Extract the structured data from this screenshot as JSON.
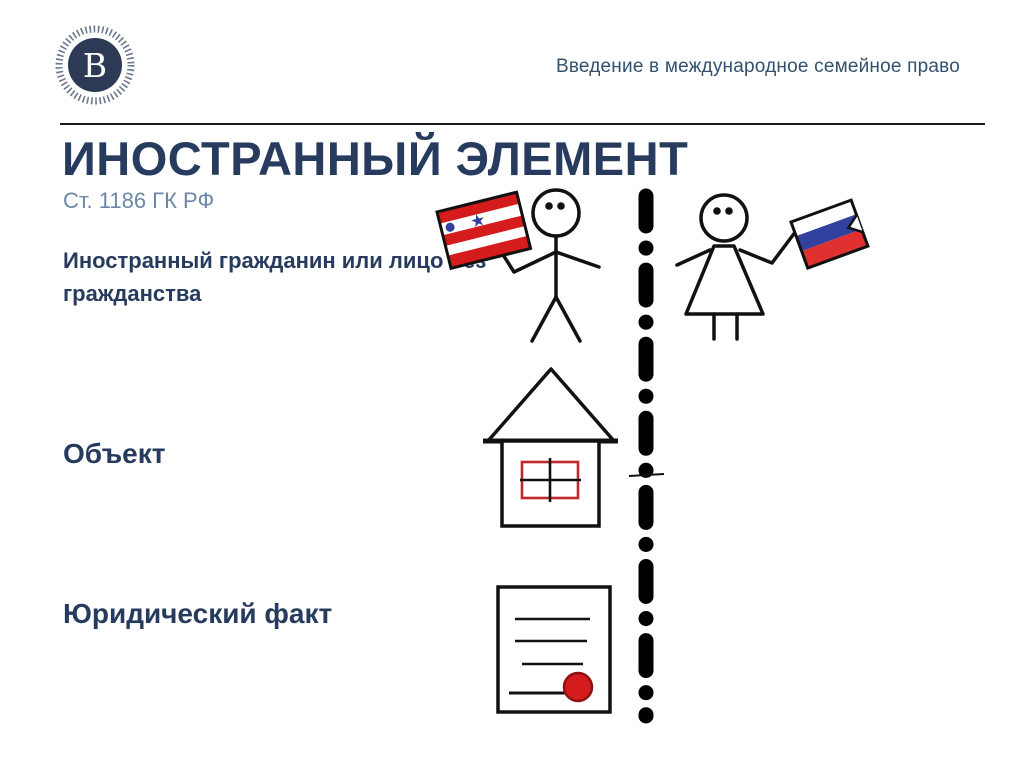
{
  "header": {
    "course_title": "Введение в международное семейное право"
  },
  "logo": {
    "name": "hse-university-logo",
    "monogram": "В"
  },
  "slide": {
    "title": "ИНОСТРАННЫЙ ЭЛЕМЕНТ",
    "subtitle": "Ст. 1186 ГК РФ",
    "items": [
      {
        "id": "subject",
        "label": "Иностранный гражданин или лицо без гражданства"
      },
      {
        "id": "object",
        "label": "Объект"
      },
      {
        "id": "legal-fact",
        "label": "Юридический факт"
      }
    ]
  },
  "illustrations": {
    "left_figure": "stick-man-with-striped-flag",
    "right_figure": "stick-woman-with-russian-flag",
    "divider": "dash-dot-border-line",
    "object_icon": "house-with-red-window",
    "fact_icon": "document-with-red-seal"
  },
  "colors": {
    "title_text": "#263b5e",
    "subtitle_text": "#6e87a8",
    "header_text": "#33506e",
    "ink": "#111111",
    "accent_red": "#d41c1c",
    "flag_blue": "#32409e",
    "logo_navy": "#2d3a55"
  }
}
